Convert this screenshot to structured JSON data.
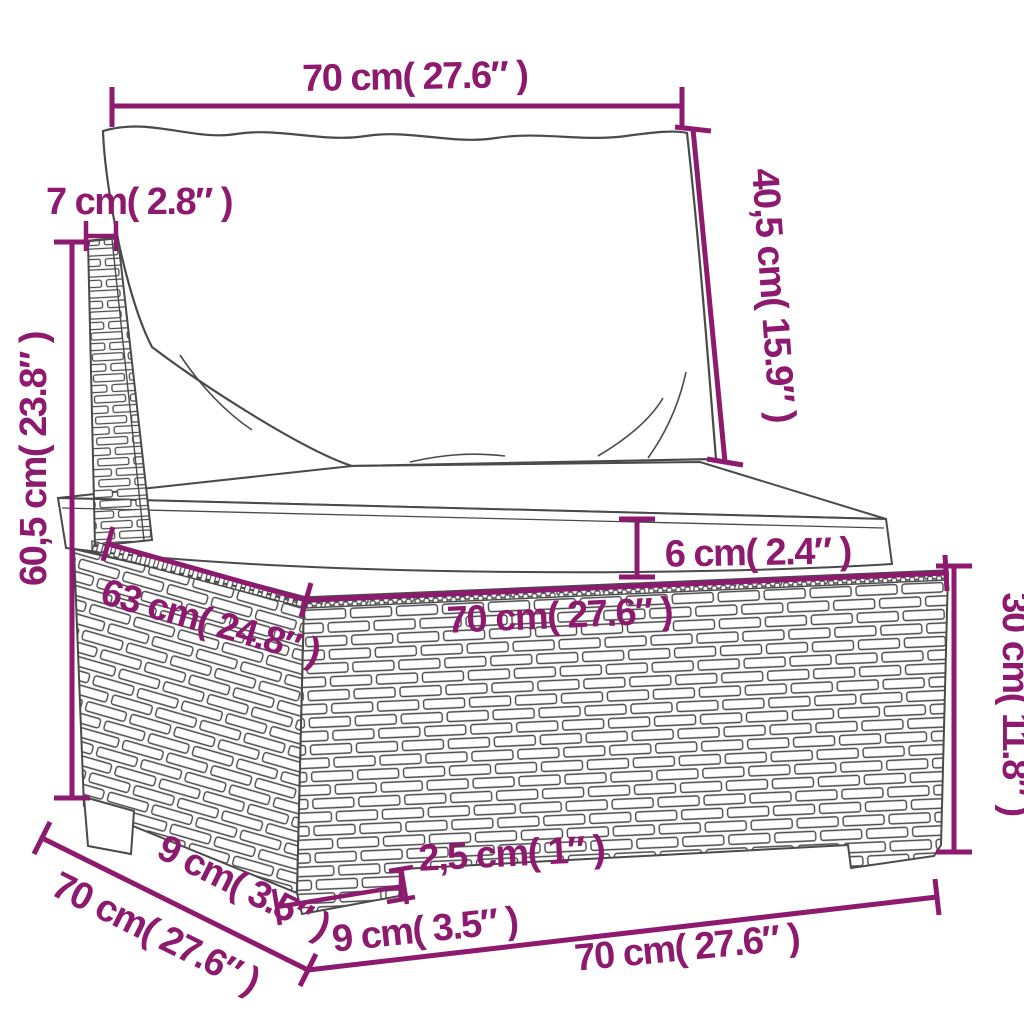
{
  "figure": {
    "type": "product dimension diagram",
    "subject": "poly rattan garden sofa section with back cushion and seat cushion"
  },
  "colors": {
    "dimension_annotation": "#8d1a6e",
    "line_art": "#4a4a4a",
    "background": "#ffffff"
  },
  "dimensions": {
    "top_width": "70 cm( 27.6″ )",
    "back_cushion_height": "40,5 cm( 15.9″ )",
    "back_panel_thickness": "7 cm( 2.8″ )",
    "total_height": "60,5 cm( 23.8″ )",
    "seat_cushion_thickness": "6 cm( 2.4″ )",
    "base_depth": "63 cm( 24.8″ )",
    "base_front_width": "70 cm( 27.6″ )",
    "base_height": "30 cm( 11.8″ )",
    "side_back_offset": "9 cm( 3.5″ )",
    "side_depth": "70 cm( 27.6″ )",
    "plinth_height": "2,5 cm( 1″ )",
    "front_leg_width": "9 cm( 3.5″ )",
    "bottom_front_width": "70 cm( 27.6″ )"
  }
}
